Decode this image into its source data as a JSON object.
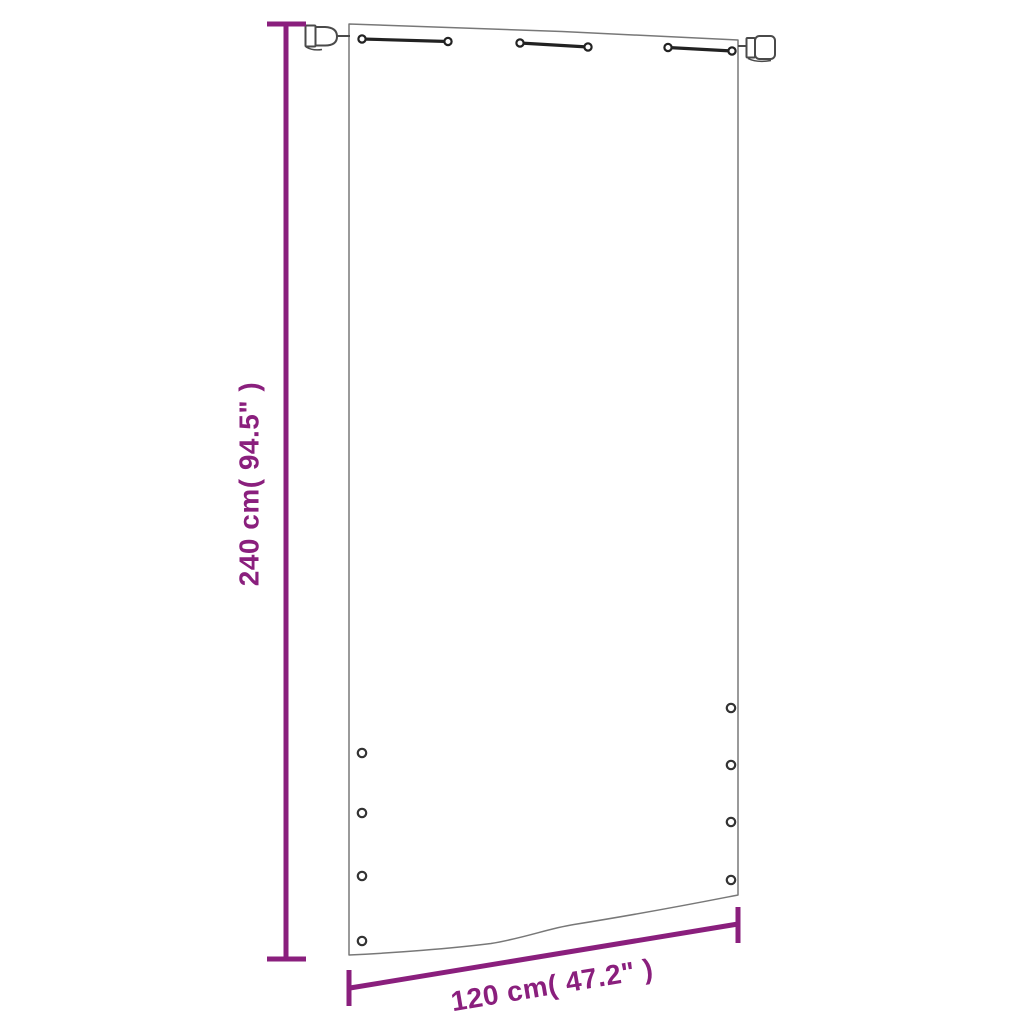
{
  "dimensions": {
    "height_label": "240 cm( 94.5\" )",
    "width_label": "120 cm( 47.2\" )"
  },
  "colors": {
    "accent": "#8A1F7D",
    "outline": "#787878",
    "hardware": "#222222"
  },
  "hardware": {
    "top_strap_count": 3,
    "left_grommet_count": 4,
    "right_grommet_count": 4,
    "bracket_count": 2
  }
}
